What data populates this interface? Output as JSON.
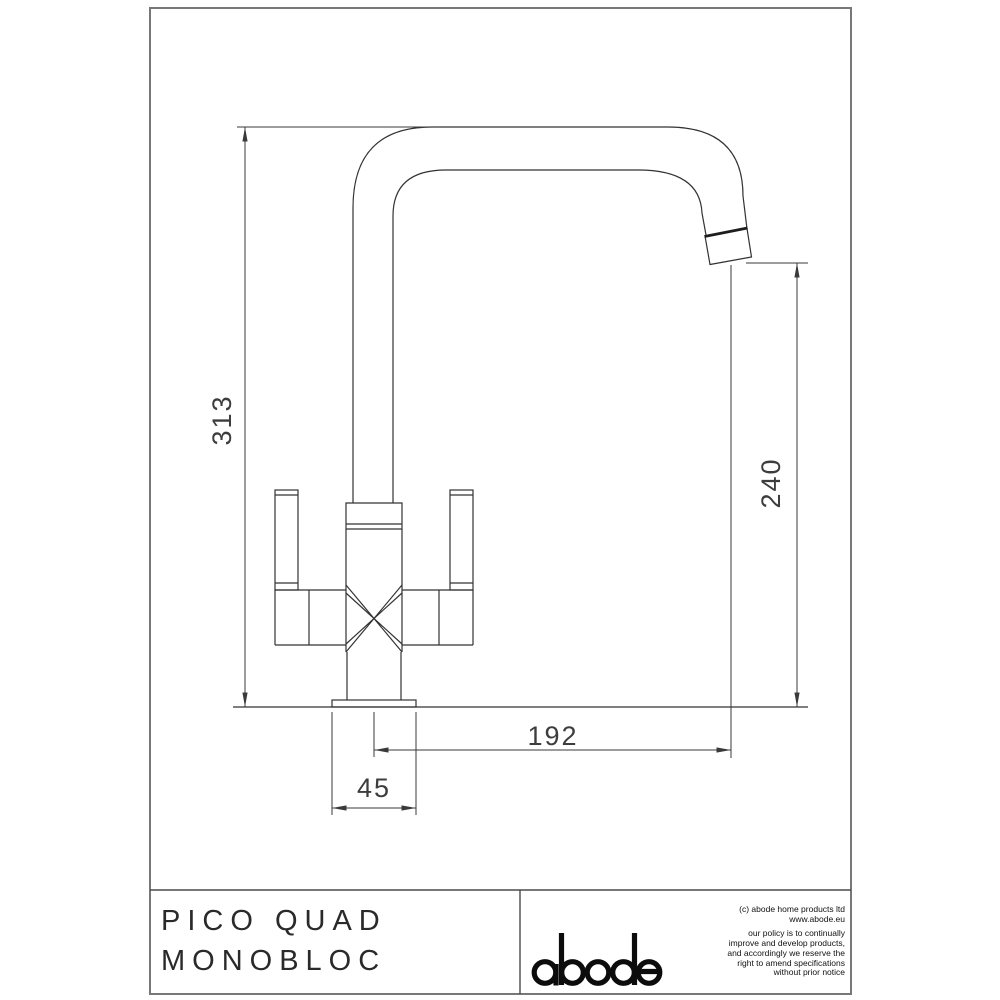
{
  "sheet": {
    "title_block": {
      "product_line1": "PICO QUAD",
      "product_line2": "MONOBLOC",
      "brand_logo": "abode",
      "copyright_line1": "(c) abode home products ltd",
      "copyright_line2": "www.abode.eu",
      "policy_line1": "our policy is to continually",
      "policy_line2": "improve and develop products,",
      "policy_line3": "and accordingly we reserve the",
      "policy_line4": "right to amend specifications",
      "policy_line5": "without prior notice"
    },
    "dimensions": {
      "overall_height_mm": "313",
      "spout_height_mm": "240",
      "spout_reach_mm": "192",
      "base_diameter_mm": "45"
    },
    "colors": {
      "line": "#333333",
      "frame": "#787878",
      "text": "#2a2a2a",
      "background": "#ffffff"
    }
  }
}
